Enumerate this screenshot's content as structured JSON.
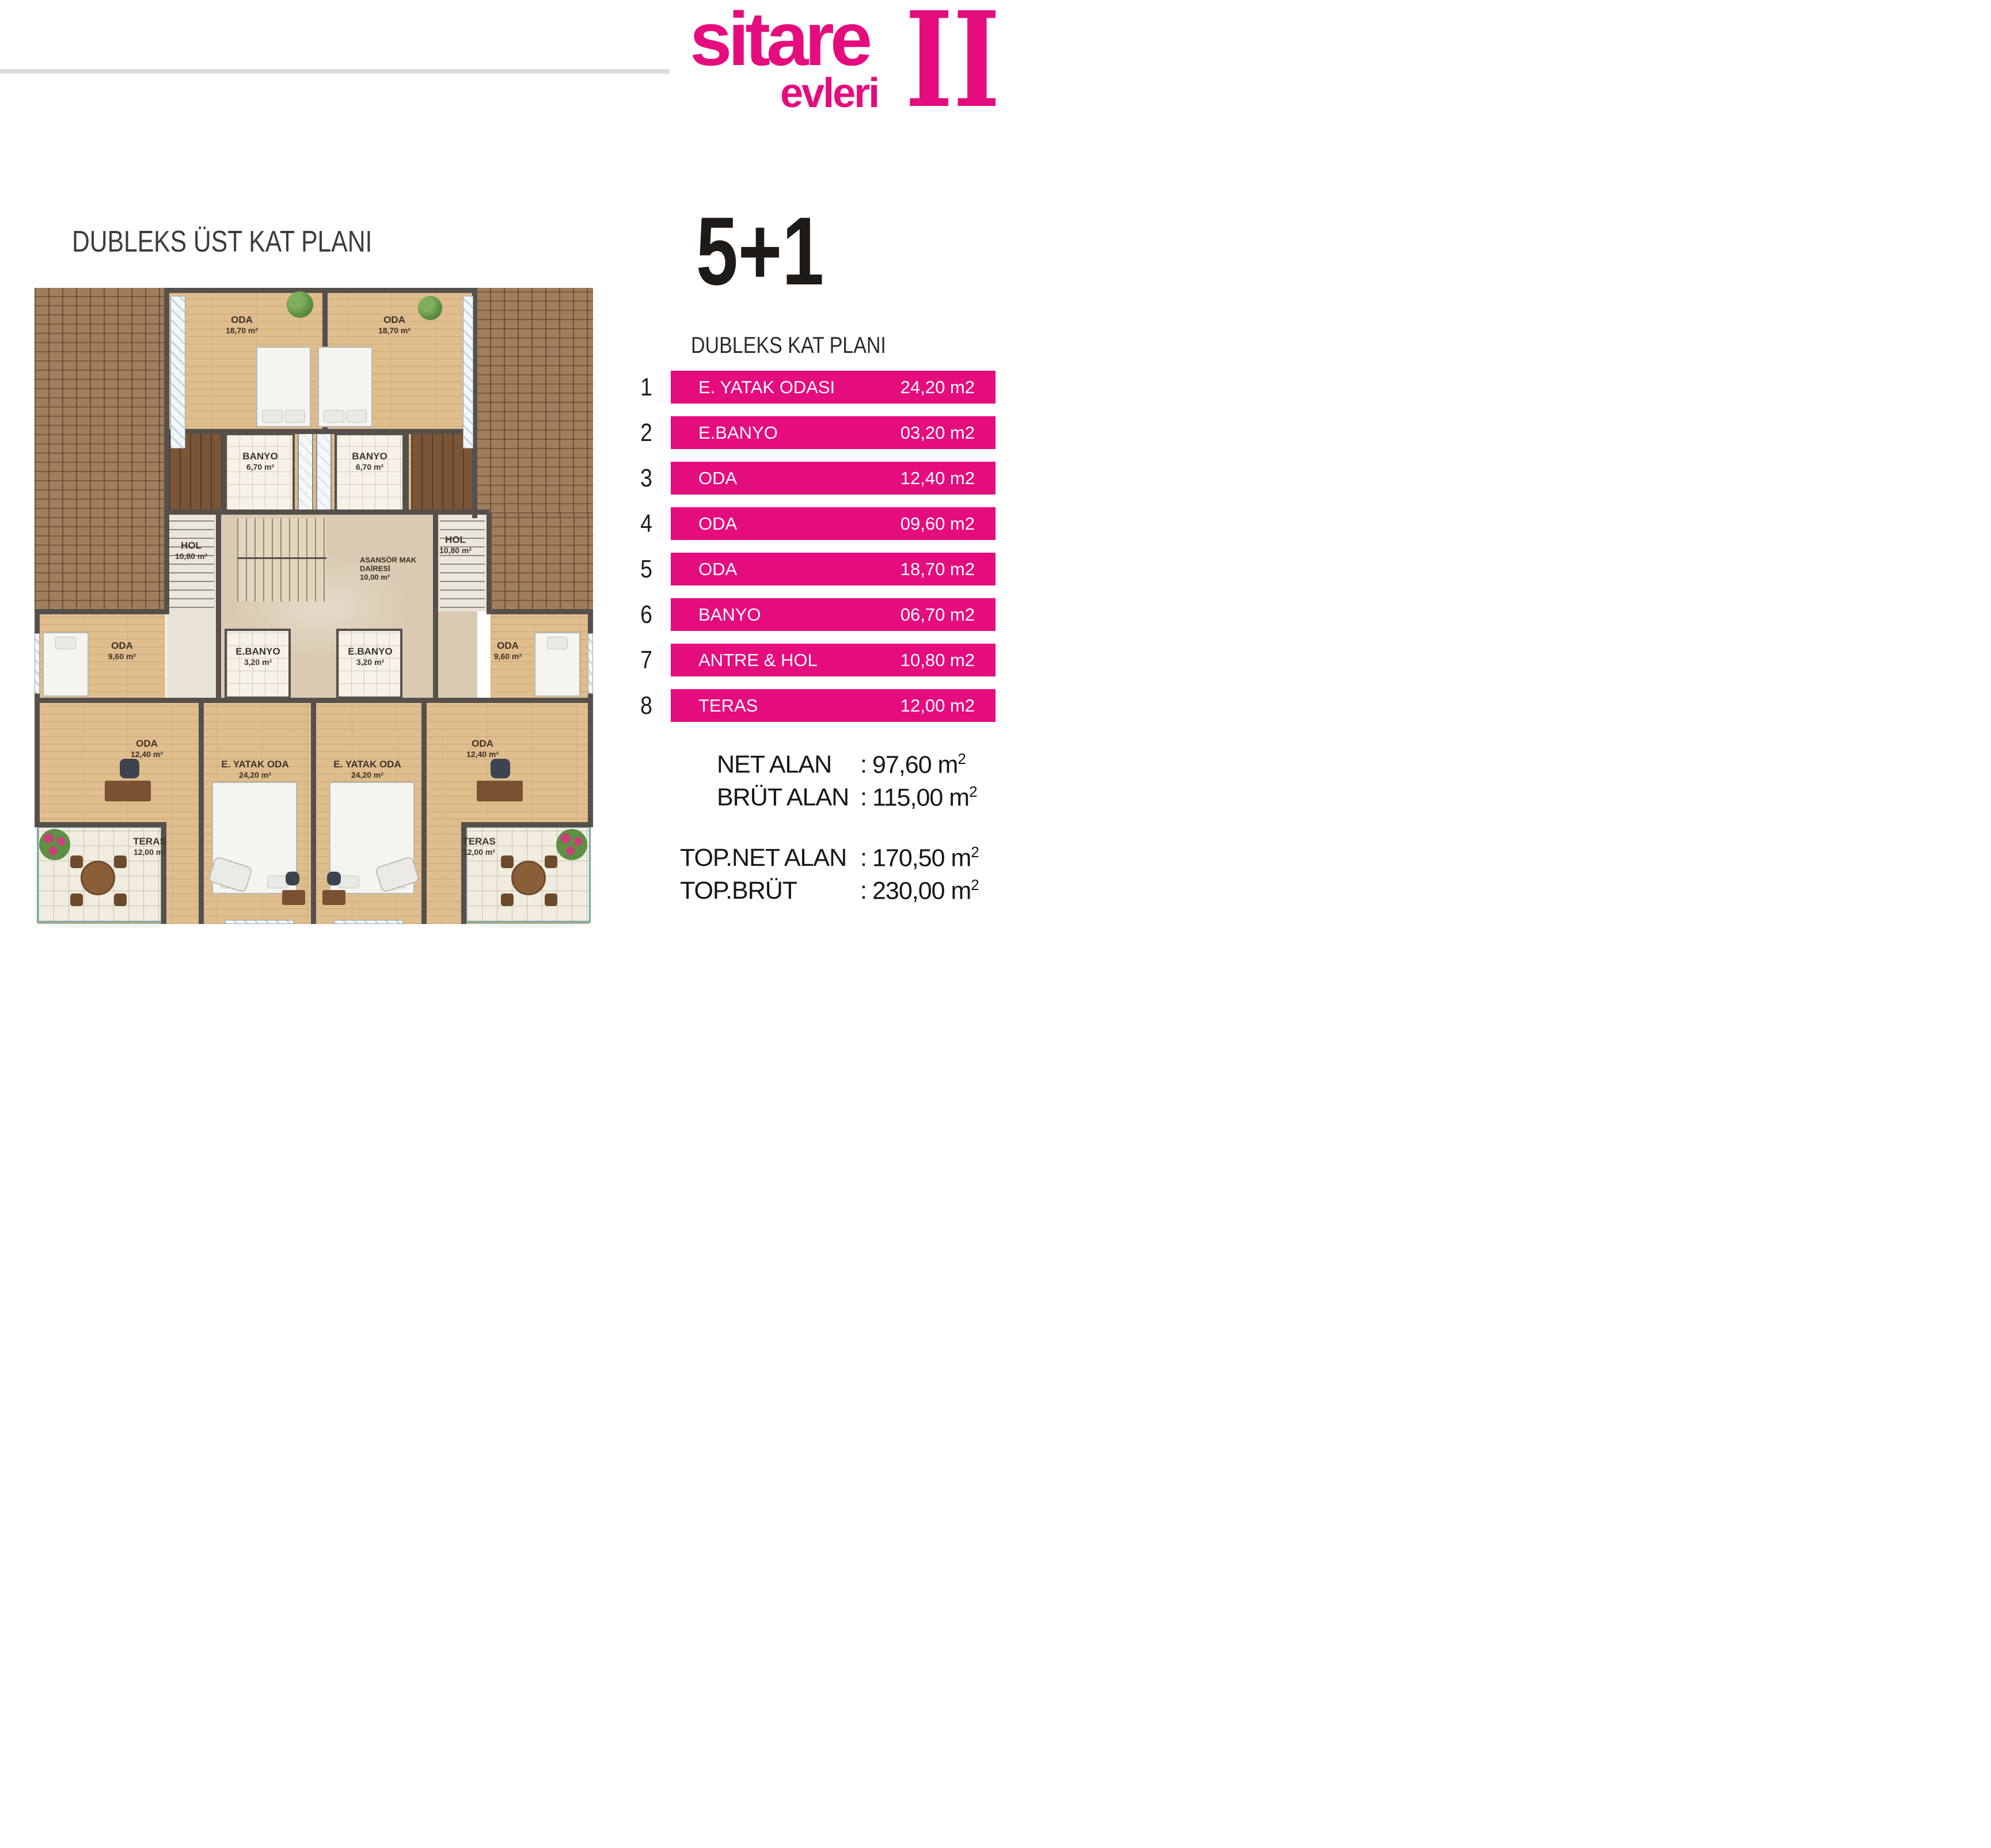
{
  "brand": {
    "logo_word1": "sitare",
    "logo_word2": "evleri",
    "logo_numeral": "II",
    "accent_color": "#e50c7e"
  },
  "header": {
    "plan_title": "DUBLEKS ÜST KAT PLANI",
    "unit_type": "5+1",
    "unit_subtitle": "DUBLEKS KAT PLANI"
  },
  "room_table": {
    "rows": [
      {
        "no": "1",
        "label": "E. YATAK ODASI",
        "area": "24,20 m2"
      },
      {
        "no": "2",
        "label": "E.BANYO",
        "area": "03,20 m2"
      },
      {
        "no": "3",
        "label": "ODA",
        "area": "12,40 m2"
      },
      {
        "no": "4",
        "label": "ODA",
        "area": "09,60 m2"
      },
      {
        "no": "5",
        "label": "ODA",
        "area": "18,70 m2"
      },
      {
        "no": "6",
        "label": "BANYO",
        "area": "06,70 m2"
      },
      {
        "no": "7",
        "label": "ANTRE & HOL",
        "area": "10,80 m2"
      },
      {
        "no": "8",
        "label": "TERAS",
        "area": "12,00 m2"
      }
    ]
  },
  "summary": {
    "net": {
      "label": "NET ALAN",
      "colon": ":",
      "value": "97,60 m",
      "sup": "2"
    },
    "brut": {
      "label": "BRÜT ALAN",
      "colon": ":",
      "value": "115,00 m",
      "sup": "2"
    },
    "top_net": {
      "label": "TOP.NET ALAN",
      "colon": ":",
      "value": "170,50 m",
      "sup": "2"
    },
    "top_brut": {
      "label": "TOP.BRÜT",
      "colon": ":",
      "value": "230,00 m",
      "sup": "2"
    }
  },
  "floor_plan": {
    "labels": {
      "oda_buyuk": {
        "name": "ODA",
        "area": "18,70 m²"
      },
      "banyo": {
        "name": "BANYO",
        "area": "6,70 m²"
      },
      "hol": {
        "name": "HOL",
        "area": "10,80 m²"
      },
      "asansor": {
        "line1": "ASANSÖR MAK",
        "line2": "DAİRESİ",
        "area": "10,00 m²"
      },
      "ebanyo": {
        "name": "E.BANYO",
        "area": "3,20 m²"
      },
      "oda_kucuk": {
        "name": "ODA",
        "area": "9,60 m²"
      },
      "oda_orta": {
        "name": "ODA",
        "area": "12,40 m²"
      },
      "eyatak": {
        "name": "E. YATAK ODA",
        "area": "24,20 m²"
      },
      "teras": {
        "name": "TERAS",
        "area": "12,00 m²"
      }
    }
  }
}
